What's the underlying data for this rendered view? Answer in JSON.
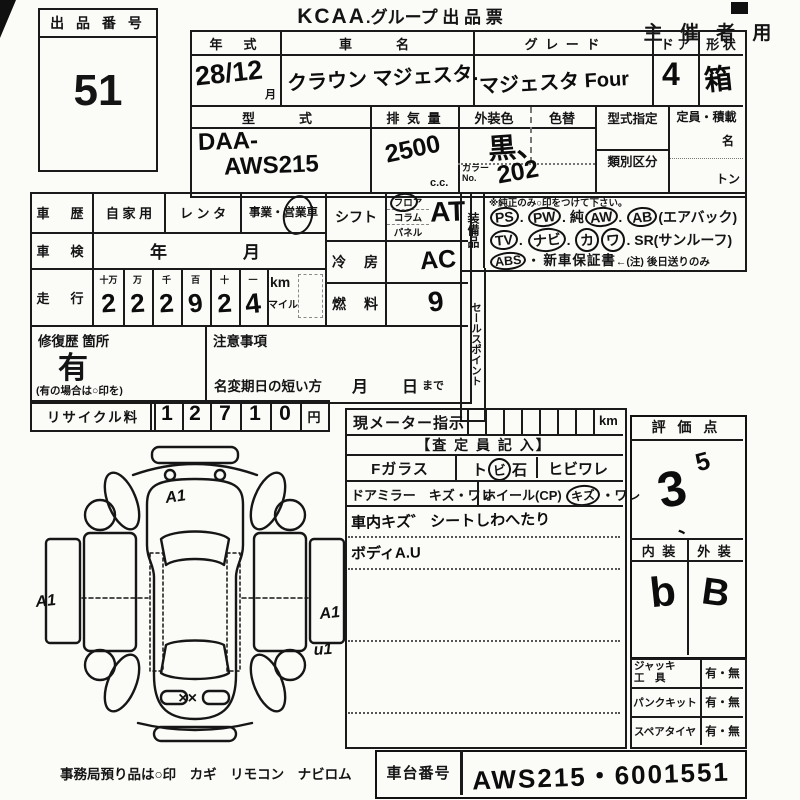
{
  "page": {
    "brand": "KCAA",
    "title_rest": ".グループ 出 品 票",
    "use": "主 催 者 用"
  },
  "lot": {
    "label": "出 品 番 号",
    "number": "51"
  },
  "top": {
    "year_label": "年　式",
    "year": "28/12",
    "month": "月",
    "name_label": "車　　名",
    "name": "クラウン マジェスタ.",
    "grade_label": "グ レ ー ド",
    "grade": "マジェスタ Four",
    "door_label": "ド ア",
    "door": "4",
    "shape_label": "形 状",
    "shape": "箱",
    "model_label": "型　　式",
    "model1": "DAA-",
    "model2": "AWS215",
    "disp_label": "排 気 量",
    "disp": "2500",
    "disp_unit": "c.c.",
    "color_label": "外装色",
    "color": "黒、",
    "color_alt_label": "色替",
    "color_no_label1": "カラー",
    "color_no_label2": "No.",
    "color_no": "202",
    "type_desig_label": "型式指定",
    "class_label": "類別区分",
    "capacity_label": "定員・積載",
    "capacity_persons": "名",
    "capacity_tons": "トン"
  },
  "left": {
    "history_label": "車　歴",
    "opt_private": "自 家 用",
    "opt_rental": "レ ン タ",
    "opt_business": "事業・営業車",
    "business_mark": "○",
    "inspection_label": "車　検",
    "inspection_year": "年",
    "inspection_month": "月",
    "mileage_label": "走　行",
    "mileage_units": [
      "十万",
      "万",
      "千",
      "百",
      "十",
      "一"
    ],
    "mileage_digits": [
      "2",
      "2",
      "2",
      "9",
      "2",
      "4"
    ],
    "km": "km",
    "mile": "マイル",
    "repair_label": "修復歴 箇所",
    "repair_value": "有",
    "repair_note": "(有の場合は○印を)",
    "caution_label": "注意事項",
    "rename_label": "名変期日の短い方",
    "rename_month": "月",
    "rename_day": "日",
    "rename_made": "まで",
    "recycle_label": "リサイクル料",
    "recycle_digits": [
      "1",
      "2",
      "7",
      "1",
      "0"
    ],
    "yen": "円"
  },
  "drive": {
    "shift_label": "シフト",
    "shift_floor": "フロア",
    "shift_column": "コラム",
    "shift_panel": "パネル",
    "shift_value": "AT",
    "ac_label": "冷　房",
    "ac_value": "AC",
    "fuel_label": "燃　料",
    "fuel_value": "9"
  },
  "equipment": {
    "side_label": "装備品",
    "note": "※純正のみ○印をつけて下さい。",
    "row1": [
      {
        "t": "PS",
        "c": 1
      },
      {
        "t": ".",
        "c": 0
      },
      {
        "t": "PW",
        "c": 1
      },
      {
        "t": ".",
        "c": 0
      },
      {
        "t": "純",
        "c": 0
      },
      {
        "t": "AW",
        "c": 1
      },
      {
        "t": ".",
        "c": 0
      },
      {
        "t": "AB",
        "c": 1
      },
      {
        "t": "(エアバック)",
        "c": 0
      }
    ],
    "row2": [
      {
        "t": "TV",
        "c": 1
      },
      {
        "t": ".",
        "c": 0
      },
      {
        "t": "ナビ",
        "c": 1
      },
      {
        "t": ".",
        "c": 0
      },
      {
        "t": "カ",
        "c": 1
      },
      {
        "t": "ワ",
        "c": 1
      },
      {
        "t": ".",
        "c": 0
      },
      {
        "t": "SR(サンルーフ)",
        "c": 0
      }
    ],
    "row3": [
      {
        "t": "ABS",
        "c": 1
      },
      {
        "t": "・",
        "c": 0
      },
      {
        "t": "新車保証書",
        "c": 0
      },
      {
        "t": "←(注) 後日送りのみ",
        "c": 0
      }
    ],
    "sales_label": "セールスポイント"
  },
  "meter": {
    "label": "現メーター指示",
    "unit": "km",
    "inspector": "【査 定 員 記 入】",
    "fglass": "Fガラス",
    "tobi_pre": "ト",
    "tobi_circ": "ビ",
    "tobi_post": "石",
    "hibi": "ヒビワレ",
    "mirror": "ドアミラー　キズ・ワレ",
    "wheel": "ホイール(CP)",
    "wheel_kizu": "キズ",
    "wheel_ware": "・ワレ",
    "note1": "車内キズ゛ シートしわへたり",
    "note2": "ボディA.U"
  },
  "eval": {
    "label": "評 価 点",
    "score_main": "3",
    "score_sup": "5",
    "score_tick": "、",
    "interior_label": "内 装",
    "interior": "b",
    "exterior_label": "外 装",
    "exterior": "B"
  },
  "tools": {
    "jack1": "ジャッキ",
    "jack2": "工　具",
    "jack_opt": "有・無",
    "punk": "パンクキット",
    "punk_opt": "有・無",
    "spare": "スペアタイヤ",
    "spare_opt": "有・無"
  },
  "chassis": {
    "label": "車台番号",
    "value": "AWS215・6001551"
  },
  "footer": {
    "note": "事務局預り品は○印　カギ　リモコン　ナビロム"
  },
  "diagram": {
    "marks": [
      {
        "t": "A1"
      },
      {
        "t": "A1"
      },
      {
        "t": "A1"
      },
      {
        "t": "u1"
      },
      {
        "t": "××"
      }
    ]
  }
}
